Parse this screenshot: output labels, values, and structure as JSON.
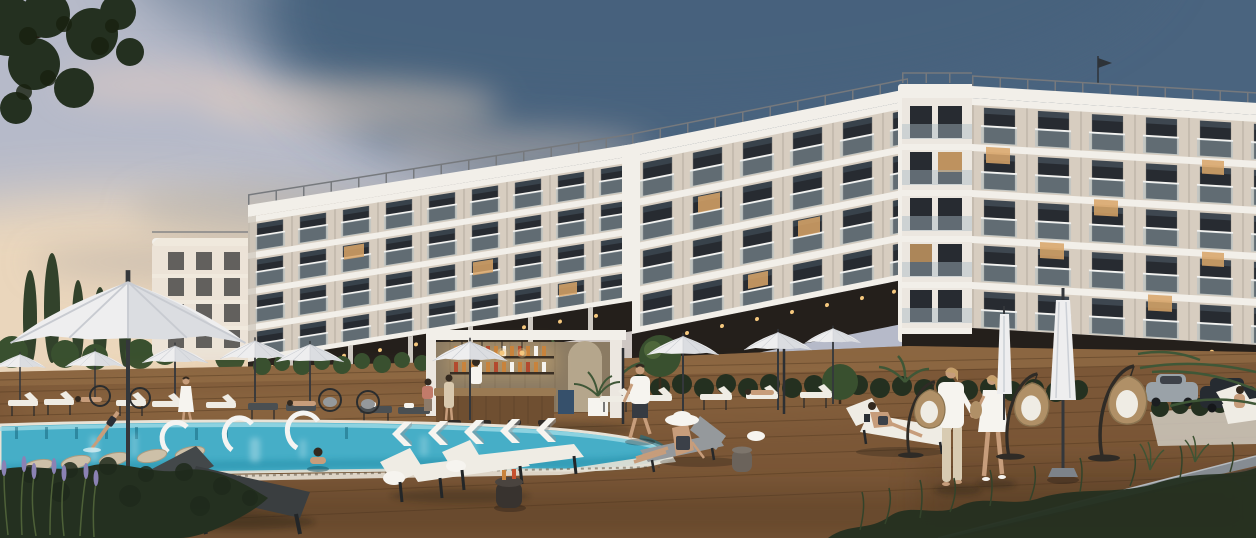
{
  "meta": {
    "title": "Seaside resort apartment complex rendering",
    "description": "Photorealistic sunset rendering of a curved white five-storey apartment resort with glass balconies, an outdoor pool with in-pool loungers and white entry arcs, a wooden deck with sun loungers, white patio umbrellas, a pool bar with lit bottle shelves, hanging rattan egg chairs, landscaped hedges and palms, and people relaxing and strolling.",
    "time_of_day": "sunset",
    "style": "architectural visualization"
  },
  "palette": {
    "sky_base": "#b6bac9",
    "sky_top": "#44607c",
    "sky_glow": "#f4dcba",
    "cloud_pink": "#e8cfbe",
    "cloud_grey": "#a9a6a2",
    "building_white": "#ece7e0",
    "building_shade": "#c6beb2",
    "building_warm": "#ecd9c3",
    "facade_stone": "#d7cdc0",
    "parapet": "#f2efe9",
    "window_dark": "#272b31",
    "window_warm": "#d9a567",
    "balcony_glass": "#a9bac4",
    "railing_metal": "#76797d",
    "arcade_dark": "#241f1b",
    "pool_water": "#46aec7",
    "pool_light": "#9fdbe6",
    "pool_deep": "#1f87a2",
    "pool_tile": "#176f88",
    "coping": "#e8e2d6",
    "water_reflect": "#e8f6f8",
    "deck": "#7b5737",
    "deck_light": "#9c764c",
    "deck_dark": "#46301b",
    "deck_plank": "#553b22",
    "platform_edge": "#868c92",
    "platform_edge_light": "#b5babf",
    "umbrella_white": "#eeeeef",
    "umbrella_shade": "#ccd0d6",
    "pole_dark": "#34373b",
    "foliage_dark": "#243020",
    "foliage_mid": "#39502f",
    "foliage_light": "#5d7742",
    "palm_green": "#3f5737",
    "cypress": "#32422b",
    "lavender": "#8b82b4",
    "rattan": "#b09067",
    "cushion_white": "#efece4",
    "cushion_grey": "#95999c",
    "frame_dark": "#2a2c2e",
    "skin": "#c79d7b",
    "hair_dark": "#33291f",
    "hair_blond": "#c6a06b",
    "cloth_white": "#f6f4ef",
    "bar_wood": "#6f4f31",
    "bar_wood_light": "#9a7a53",
    "bar_back": "#8b7b63",
    "bottle_amber": "#c8833c",
    "bottle_red": "#b34a2e",
    "light_warm": "#f6c87e",
    "car_dark": "#262b31",
    "car_grey": "#9aa2a8",
    "planter_white": "#cfcac0",
    "shadow": "#141210"
  },
  "scene": {
    "buildings": {
      "main_complex": "curved white apartment block, 4-5 storeys, stone-tile facade, glass balconies, rooftop railing, dark ground-floor arcade with warm lights",
      "distant_building": "small white 4-storey block at far left",
      "lit_windows": "scattered warm interior lights, more on right wing",
      "flag_on_roof": true
    },
    "pool_area": {
      "umbrellas_open": 10,
      "umbrellas_closed": 2,
      "sun_loungers": "rows of white and charcoal loungers around pool",
      "in_pool_cylinder_loungers": 5,
      "in_pool_chevron_loungers": 5,
      "white_entry_arcs": 3,
      "pool_bar": "timber bar with bottle shelves, pendant lights, stools, bartender",
      "egg_chairs": 3,
      "wicker_ring_chairs": 4,
      "side_tables_with_cocktails": 2
    },
    "people": [
      "diver entering pool",
      "woman in pool at edge",
      "woman in white dress walking",
      "bartender",
      "guests at bar table",
      "man strolling in white tee",
      "woman with wide white sun hat on lounger",
      "woman reading on lounger",
      "couple standing on deck",
      "sunbathers on loungers",
      "partial guest at right edge"
    ],
    "vegetation": [
      "pine branch top-left",
      "cypress trees",
      "round clipped trees",
      "hedges with white planter",
      "palm fronds",
      "lavender",
      "foreground pine shrub",
      "grasses bottom-right"
    ],
    "vehicles": [
      "silver SUV",
      "dark SUV parked behind hedge"
    ],
    "ground": "wide timber deck with raised platform edge at right"
  }
}
